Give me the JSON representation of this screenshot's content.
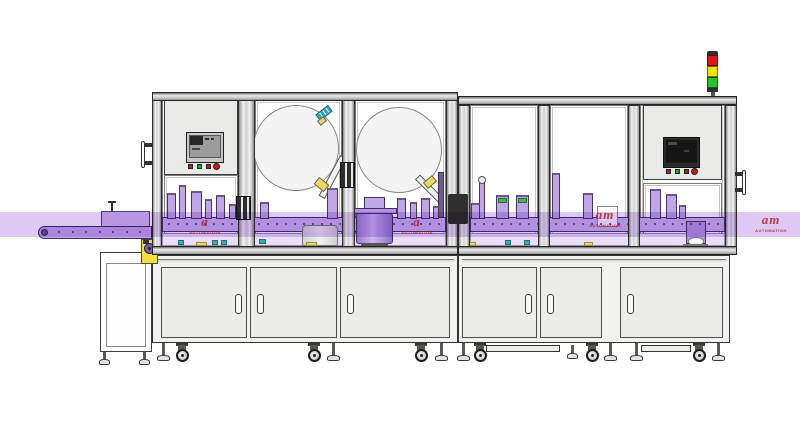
{
  "scene": {
    "kind": "cad-rendering",
    "subject": "automated assembly, labeling and inspection machine line with infeed conveyor and signal tower"
  },
  "palette": {
    "outline": "#3a3752",
    "frame_metal": "#ececec",
    "panel": "#e9e9e7",
    "door": "#ecece9",
    "reel": "#f4f4f4",
    "highlight_band": "rgba(187,148,231,0.5)",
    "belt_purple": "#c7a8e9",
    "machinery_purple": "#bfa6e6",
    "rail_purple": "#cdb6ec",
    "shelf_purple": "#eadff7",
    "accent_yellow": "#f2e03a",
    "accent_teal": "#3aacac",
    "watermark_red": "#c92626"
  },
  "signal_tower": {
    "segments": [
      {
        "name": "red",
        "color": "#e21414"
      },
      {
        "name": "yellow",
        "color": "#f2e40c"
      },
      {
        "name": "green",
        "color": "#27c32b"
      }
    ]
  },
  "watermarks": [
    {
      "x": 182,
      "y": 214,
      "logo": "a",
      "caption": "AUTOMATION"
    },
    {
      "x": 394,
      "y": 214,
      "logo": "a",
      "caption": "AUTOMATION"
    },
    {
      "x": 582,
      "y": 207,
      "logo": "am",
      "caption": "AUTOMATION"
    },
    {
      "x": 748,
      "y": 212,
      "logo": "am",
      "caption": "AUTOMATION"
    }
  ],
  "hmi": {
    "left_buttons": [
      "#c81414",
      "#18a81e",
      "#c81414",
      "#d01414"
    ],
    "right_buttons": [
      "#c81414",
      "#18a81e",
      "#c81414",
      "#d01414"
    ]
  },
  "left_machine": {
    "reels": [
      {
        "cx": 296,
        "cy": 148,
        "r": 43
      },
      {
        "cx": 399,
        "cy": 150,
        "r": 43
      }
    ],
    "stations": [
      {
        "x": 167,
        "w": 9,
        "h": 26
      },
      {
        "x": 179,
        "w": 7,
        "h": 34
      },
      {
        "x": 191,
        "w": 11,
        "h": 28
      },
      {
        "x": 205,
        "w": 7,
        "h": 20
      },
      {
        "x": 216,
        "w": 9,
        "h": 24
      },
      {
        "x": 229,
        "w": 7,
        "h": 15
      },
      {
        "x": 260,
        "w": 9,
        "h": 17
      },
      {
        "x": 327,
        "w": 11,
        "h": 31
      },
      {
        "x": 397,
        "w": 9,
        "h": 21
      },
      {
        "x": 410,
        "w": 7,
        "h": 17
      },
      {
        "x": 421,
        "w": 9,
        "h": 21
      },
      {
        "x": 433,
        "w": 6,
        "h": 13
      }
    ],
    "doors": [
      {
        "x": 161,
        "w": 86,
        "handle": "right"
      },
      {
        "x": 250,
        "w": 87,
        "handle": "left"
      },
      {
        "x": 340,
        "w": 110,
        "handle": "left"
      }
    ]
  },
  "right_machine": {
    "stations": [
      {
        "x": 471,
        "w": 12,
        "h": 16
      },
      {
        "x": 479,
        "w": 6,
        "h": 40,
        "cap": "circle"
      },
      {
        "x": 496,
        "w": 13,
        "h": 24,
        "cap": "green"
      },
      {
        "x": 516,
        "w": 13,
        "h": 24,
        "cap": "green"
      },
      {
        "x": 552,
        "w": 8,
        "h": 46
      },
      {
        "x": 583,
        "w": 10,
        "h": 26
      },
      {
        "x": 650,
        "w": 11,
        "h": 30
      },
      {
        "x": 666,
        "w": 11,
        "h": 25
      },
      {
        "x": 679,
        "w": 7,
        "h": 14
      }
    ],
    "doors": [
      {
        "x": 462,
        "w": 75,
        "handle": "right"
      },
      {
        "x": 540,
        "w": 62,
        "handle": "left"
      },
      {
        "x": 620,
        "w": 103,
        "handle": "left"
      }
    ],
    "skids": [
      {
        "x": 486,
        "w": 74
      },
      {
        "x": 641,
        "w": 50
      }
    ]
  },
  "accents": [
    {
      "x": 178,
      "y": 240,
      "w": 6,
      "h": 5,
      "c": "#3aacac"
    },
    {
      "x": 212,
      "y": 240,
      "w": 6,
      "h": 5,
      "c": "#3aacac"
    },
    {
      "x": 221,
      "y": 240,
      "w": 6,
      "h": 5,
      "c": "#3aacac"
    },
    {
      "x": 259,
      "y": 239,
      "w": 7,
      "h": 5,
      "c": "#3aacac"
    },
    {
      "x": 196,
      "y": 242,
      "w": 11,
      "h": 4,
      "c": "#e9d96a"
    },
    {
      "x": 306,
      "y": 242,
      "w": 11,
      "h": 4,
      "c": "#e9d96a"
    },
    {
      "x": 505,
      "y": 240,
      "w": 6,
      "h": 5,
      "c": "#3aacac"
    },
    {
      "x": 524,
      "y": 240,
      "w": 6,
      "h": 5,
      "c": "#3aacac"
    },
    {
      "x": 466,
      "y": 242,
      "w": 10,
      "h": 4,
      "c": "#e9d96a"
    },
    {
      "x": 584,
      "y": 242,
      "w": 9,
      "h": 4,
      "c": "#e9d96a"
    }
  ],
  "machine_supports": [
    {
      "t": "jack",
      "x": 163
    },
    {
      "t": "caster",
      "x": 182
    },
    {
      "t": "caster",
      "x": 314
    },
    {
      "t": "jack",
      "x": 333
    },
    {
      "t": "caster",
      "x": 421
    },
    {
      "t": "jack",
      "x": 441
    },
    {
      "t": "jack",
      "x": 463
    },
    {
      "t": "caster",
      "x": 480
    },
    {
      "t": "jacks",
      "x": 572
    },
    {
      "t": "caster",
      "x": 592
    },
    {
      "t": "jack",
      "x": 610
    },
    {
      "t": "jack",
      "x": 636
    },
    {
      "t": "caster",
      "x": 699
    },
    {
      "t": "jack",
      "x": 718
    }
  ],
  "conveyor": {
    "belt_dot_count": 7,
    "stand_feet": [
      {
        "x": 104
      },
      {
        "x": 144
      }
    ]
  }
}
